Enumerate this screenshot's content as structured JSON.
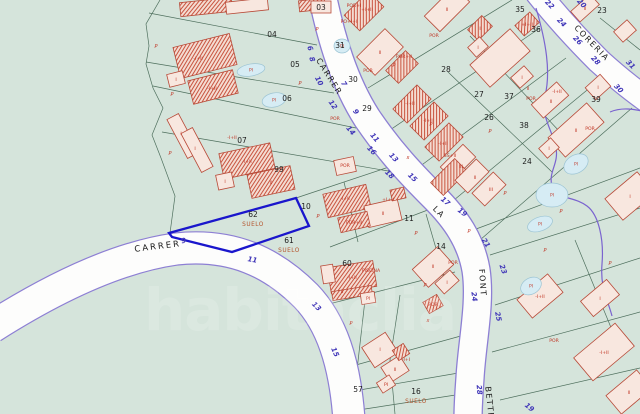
{
  "map_type": "cadastral-parcel-map",
  "watermark": "habitaclia",
  "highlight_parcel": {
    "number": "62",
    "status": "SUELO"
  },
  "colors": {
    "background": "#d5e4db",
    "boundary": "#4e6f5d",
    "road_fill": "#fdfdfc",
    "road_edge": "#8d7fd4",
    "utility": "#7a63cf",
    "highlight": "#1a16cc",
    "building_fill": "#f8e7df",
    "building_hatch_base": "#f4dcd2",
    "hatch": "#c8543f",
    "building_stroke": "#b84a38",
    "red_label": "#c03322",
    "parcel_number": "#1c1c1c",
    "street_number": "#4036b8",
    "road_name": "#1b1b1b",
    "pool_fill": "#d6ecf4",
    "pool_stroke": "#9cc4d4",
    "suelo": "#b5542c",
    "watermark_color": "#ffffff"
  },
  "road_names": [
    {
      "t": "CARRER",
      "x": 327,
      "y": 78,
      "r": 58,
      "cls": "t-road"
    },
    {
      "t": "CARRER",
      "x": 158,
      "y": 249,
      "r": -7,
      "cls": "t-road2"
    },
    {
      "t": "LA",
      "x": 437,
      "y": 214,
      "r": 45,
      "cls": "t-road"
    },
    {
      "t": "FONT",
      "x": 480,
      "y": 283,
      "r": 86,
      "cls": "t-road"
    },
    {
      "t": "BETTE",
      "x": 487,
      "y": 403,
      "r": 84,
      "cls": "t-road"
    },
    {
      "t": "CORERIA",
      "x": 590,
      "y": 45,
      "r": 46,
      "cls": "t-road"
    }
  ],
  "street_numbers": [
    [
      "6",
      308,
      49,
      70
    ],
    [
      "8",
      310,
      60,
      70
    ],
    [
      "10",
      317,
      82,
      62
    ],
    [
      "12",
      331,
      106,
      55
    ],
    [
      "14",
      349,
      132,
      50
    ],
    [
      "16",
      370,
      152,
      47
    ],
    [
      "18",
      388,
      176,
      44
    ],
    [
      "7",
      342,
      85,
      58
    ],
    [
      "9",
      354,
      113,
      55
    ],
    [
      "11",
      373,
      139,
      50
    ],
    [
      "13",
      392,
      159,
      47
    ],
    [
      "15",
      411,
      179,
      44
    ],
    [
      "17",
      444,
      203,
      40
    ],
    [
      "19",
      461,
      214,
      38
    ],
    [
      "21",
      484,
      244,
      58
    ],
    [
      "23",
      501,
      270,
      70
    ],
    [
      "24",
      472,
      297,
      82
    ],
    [
      "25",
      496,
      317,
      78
    ],
    [
      "28",
      477,
      390,
      85
    ],
    [
      "19",
      528,
      409,
      40
    ],
    [
      "9",
      184,
      243,
      -10
    ],
    [
      "11",
      252,
      262,
      10
    ],
    [
      "13",
      315,
      308,
      45
    ],
    [
      "15",
      333,
      353,
      66
    ],
    [
      "22",
      548,
      6,
      46
    ],
    [
      "20",
      580,
      5,
      46
    ],
    [
      "24",
      560,
      24,
      46
    ],
    [
      "26",
      576,
      42,
      46
    ],
    [
      "28",
      594,
      62,
      46
    ],
    [
      "30",
      617,
      90,
      46
    ],
    [
      "31",
      629,
      66,
      46
    ]
  ],
  "parcel_numbers": [
    [
      "03",
      321,
      10
    ],
    [
      "04",
      272,
      37
    ],
    [
      "05",
      295,
      67
    ],
    [
      "06",
      287,
      101
    ],
    [
      "07",
      242,
      143
    ],
    [
      "99",
      279,
      172
    ],
    [
      "10",
      306,
      209
    ],
    [
      "11",
      409,
      221
    ],
    [
      "14",
      441,
      249
    ],
    [
      "62",
      253,
      217
    ],
    [
      "61",
      289,
      243
    ],
    [
      "60",
      347,
      266
    ],
    [
      "16",
      416,
      394
    ],
    [
      "57",
      358,
      392
    ],
    [
      "23",
      602,
      13
    ],
    [
      "24",
      527,
      164
    ],
    [
      "26",
      489,
      120
    ],
    [
      "27",
      479,
      97
    ],
    [
      "28",
      446,
      72
    ],
    [
      "29",
      367,
      111
    ],
    [
      "30",
      353,
      82
    ],
    [
      "31",
      340,
      48
    ],
    [
      "35",
      520,
      12
    ],
    [
      "36",
      536,
      32
    ],
    [
      "37",
      509,
      99
    ],
    [
      "38",
      524,
      128
    ],
    [
      "39",
      596,
      102
    ]
  ],
  "status_labels": [
    {
      "t": "SUELO",
      "x": 253,
      "y": 226
    },
    {
      "t": "SUELO",
      "x": 289,
      "y": 252
    },
    {
      "t": "SUELO",
      "x": 416,
      "y": 403
    }
  ],
  "building_labels": [
    [
      "-I+II",
      198,
      60
    ],
    [
      "I",
      176,
      81
    ],
    [
      "-I+II",
      212,
      90
    ],
    [
      "I",
      181,
      135
    ],
    [
      "I",
      195,
      150
    ],
    [
      "-I+II",
      232,
      139
    ],
    [
      "-I+II",
      247,
      163
    ],
    [
      "II",
      271,
      184
    ],
    [
      "I",
      225,
      183
    ],
    [
      "POR+I",
      354,
      7
    ],
    [
      "+I+II",
      367,
      11
    ],
    [
      "PO+I+I",
      349,
      23
    ],
    [
      "POR",
      434,
      37
    ],
    [
      "II",
      447,
      11
    ],
    [
      "I",
      480,
      30
    ],
    [
      "II",
      380,
      54
    ],
    [
      "POR+II",
      404,
      58
    ],
    [
      "POR",
      368,
      72
    ],
    [
      "POR",
      335,
      120
    ],
    [
      "-I+II",
      410,
      105
    ],
    [
      "-I+II",
      428,
      122
    ],
    [
      "-I+II",
      443,
      145
    ],
    [
      "SS+II",
      450,
      157
    ],
    [
      "III",
      461,
      168
    ],
    [
      "II",
      475,
      179
    ],
    [
      "III",
      491,
      191
    ],
    [
      "II",
      528,
      90
    ],
    [
      "I",
      478,
      49
    ],
    [
      "I",
      522,
      79
    ],
    [
      "I",
      598,
      89
    ],
    [
      "+I+II",
      527,
      26
    ],
    [
      "II",
      585,
      10
    ],
    [
      "-I+II",
      557,
      93
    ],
    [
      "POR",
      531,
      100
    ],
    [
      "II",
      551,
      103
    ],
    [
      "II",
      576,
      132
    ],
    [
      "POR",
      590,
      130
    ],
    [
      "I",
      549,
      150
    ],
    [
      "-I+II",
      345,
      200
    ],
    [
      "+I+II",
      388,
      201
    ],
    [
      "II",
      383,
      215
    ],
    [
      "POR+II",
      354,
      224
    ],
    [
      "POR",
      345,
      167
    ],
    [
      "PISCINA",
      371,
      272
    ],
    [
      "-I+II",
      352,
      279
    ],
    [
      "II",
      342,
      293
    ],
    [
      "PI",
      368,
      300
    ],
    [
      "II",
      433,
      268
    ],
    [
      "I",
      447,
      284
    ],
    [
      "POR",
      453,
      264
    ],
    [
      "I",
      380,
      351
    ],
    [
      "II",
      395,
      371
    ],
    [
      "-I+I",
      406,
      361
    ],
    [
      "PI",
      386,
      386
    ],
    [
      "POR",
      433,
      306
    ],
    [
      "-I+II",
      540,
      298
    ],
    [
      "POR",
      554,
      342
    ],
    [
      "I",
      600,
      300
    ],
    [
      "-I+II",
      604,
      354
    ],
    [
      "II",
      629,
      394
    ],
    [
      "I",
      630,
      198
    ]
  ],
  "marks": [
    [
      "P",
      156,
      48
    ],
    [
      "P",
      172,
      96
    ],
    [
      "P",
      170,
      155
    ],
    [
      "P",
      317,
      31
    ],
    [
      "P",
      394,
      67
    ],
    [
      "P",
      431,
      126
    ],
    [
      "P",
      416,
      235
    ],
    [
      "P",
      318,
      218
    ],
    [
      "P",
      469,
      233
    ],
    [
      "P",
      351,
      325
    ],
    [
      "P",
      490,
      133
    ],
    [
      "P",
      561,
      213
    ],
    [
      "P",
      610,
      265
    ],
    [
      "P",
      425,
      287
    ],
    [
      "P",
      505,
      195
    ],
    [
      "P",
      545,
      252
    ],
    [
      "P",
      300,
      85
    ],
    [
      "x",
      408,
      159
    ],
    [
      "x",
      428,
      322
    ]
  ],
  "pool_label": "PI",
  "pools": [
    [
      251,
      70,
      14,
      6,
      -10
    ],
    [
      274,
      100,
      12,
      7,
      -12
    ],
    [
      552,
      195,
      16,
      12,
      0
    ],
    [
      576,
      164,
      13,
      9,
      -30
    ],
    [
      540,
      224,
      13,
      7,
      -20
    ],
    [
      531,
      286,
      11,
      8,
      -30
    ],
    [
      342,
      46,
      8,
      7,
      0
    ]
  ],
  "buildings": [
    [
      205,
      56,
      58,
      32,
      -14,
      "h"
    ],
    [
      176,
      79,
      16,
      13,
      -14,
      "p"
    ],
    [
      213,
      87,
      46,
      24,
      -14,
      "h"
    ],
    [
      206,
      7,
      52,
      14,
      -6,
      "h"
    ],
    [
      247,
      6,
      42,
      12,
      -6,
      "p"
    ],
    [
      312,
      5,
      26,
      11,
      -6,
      "h"
    ],
    [
      321,
      7,
      20,
      12,
      0,
      "p"
    ],
    [
      364,
      11,
      34,
      22,
      -45,
      "h"
    ],
    [
      447,
      9,
      42,
      22,
      -45,
      "p"
    ],
    [
      480,
      28,
      20,
      15,
      -45,
      "h"
    ],
    [
      500,
      58,
      54,
      30,
      -42,
      "p"
    ],
    [
      478,
      47,
      16,
      13,
      -42,
      "p"
    ],
    [
      522,
      77,
      18,
      14,
      -42,
      "p"
    ],
    [
      527,
      24,
      20,
      14,
      -42,
      "h"
    ],
    [
      598,
      87,
      20,
      16,
      -42,
      "p"
    ],
    [
      625,
      31,
      18,
      14,
      -42,
      "p"
    ],
    [
      585,
      8,
      26,
      14,
      -42,
      "p"
    ],
    [
      380,
      52,
      40,
      26,
      -45,
      "p"
    ],
    [
      402,
      67,
      28,
      18,
      -45,
      "h"
    ],
    [
      412,
      104,
      34,
      20,
      -45,
      "h"
    ],
    [
      429,
      121,
      34,
      20,
      -45,
      "h"
    ],
    [
      444,
      142,
      34,
      20,
      -45,
      "h"
    ],
    [
      458,
      162,
      32,
      18,
      -45,
      "p"
    ],
    [
      449,
      177,
      34,
      18,
      -45,
      "h"
    ],
    [
      472,
      176,
      30,
      18,
      -45,
      "p"
    ],
    [
      489,
      189,
      30,
      18,
      -45,
      "p"
    ],
    [
      345,
      166,
      20,
      15,
      -12,
      "p"
    ],
    [
      550,
      100,
      34,
      18,
      -42,
      "p"
    ],
    [
      576,
      130,
      52,
      26,
      -42,
      "p"
    ],
    [
      549,
      148,
      16,
      13,
      -42,
      "p"
    ],
    [
      347,
      201,
      44,
      24,
      -13,
      "h"
    ],
    [
      383,
      213,
      34,
      22,
      -13,
      "p"
    ],
    [
      354,
      222,
      30,
      15,
      -13,
      "h"
    ],
    [
      398,
      194,
      14,
      11,
      -13,
      "h"
    ],
    [
      352,
      277,
      46,
      26,
      -9,
      "h"
    ],
    [
      328,
      274,
      12,
      18,
      -9,
      "p"
    ],
    [
      352,
      293,
      40,
      9,
      -9,
      "h"
    ],
    [
      368,
      298,
      14,
      11,
      -9,
      "p"
    ],
    [
      433,
      267,
      34,
      24,
      -42,
      "p"
    ],
    [
      447,
      282,
      20,
      14,
      -42,
      "p"
    ],
    [
      380,
      350,
      28,
      24,
      -33,
      "p"
    ],
    [
      395,
      369,
      22,
      18,
      -33,
      "p"
    ],
    [
      401,
      352,
      13,
      12,
      -33,
      "h"
    ],
    [
      386,
      384,
      15,
      12,
      -33,
      "p"
    ],
    [
      433,
      304,
      16,
      13,
      -30,
      "h"
    ],
    [
      540,
      296,
      40,
      24,
      -40,
      "p"
    ],
    [
      600,
      298,
      34,
      20,
      -40,
      "p"
    ],
    [
      604,
      352,
      54,
      30,
      -40,
      "p"
    ],
    [
      629,
      392,
      40,
      24,
      -40,
      "p"
    ],
    [
      630,
      196,
      42,
      28,
      -40,
      "p"
    ],
    [
      183,
      136,
      44,
      13,
      62,
      "p"
    ],
    [
      197,
      150,
      44,
      13,
      62,
      "p"
    ],
    [
      247,
      161,
      52,
      26,
      -12,
      "h"
    ],
    [
      271,
      182,
      44,
      24,
      -12,
      "h"
    ],
    [
      225,
      181,
      16,
      15,
      -12,
      "p"
    ]
  ]
}
